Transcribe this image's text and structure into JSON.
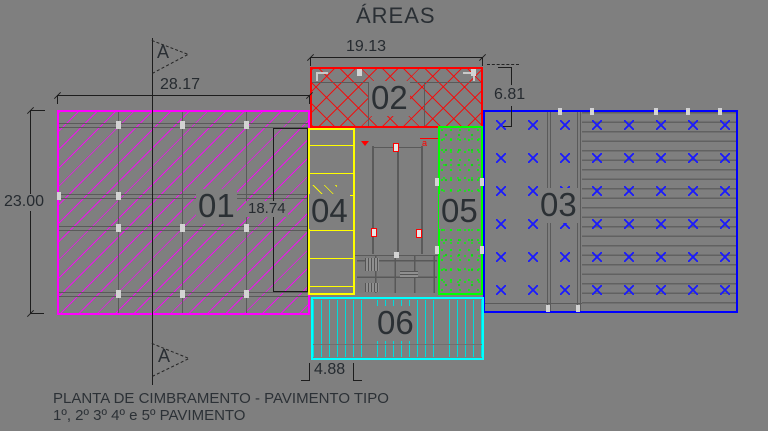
{
  "title": "ÁREAS",
  "section": {
    "label": "A"
  },
  "areas": {
    "a01": {
      "label": "01",
      "color": "#ff00ff"
    },
    "a02": {
      "label": "02",
      "color": "#ff0000"
    },
    "a03": {
      "label": "03",
      "color": "#0000ff",
      "x_grid": {
        "cols": 8,
        "rows": 6
      }
    },
    "a04": {
      "label": "04",
      "color": "#ffff00"
    },
    "a05": {
      "label": "05",
      "color": "#00ff00"
    },
    "a06": {
      "label": "06",
      "color": "#00ffff"
    }
  },
  "dimensions": {
    "area01_width": "28.17",
    "area01_height": "23.00",
    "area02_width": "19.13",
    "area02_height": "6.81",
    "core_height": "18.74",
    "area06_left_width": "4.88"
  },
  "core": {
    "door_letter": "a"
  },
  "notes": {
    "line1": "PLANTA DE CIMBRAMENTO - PAVIMENTO TIPO",
    "line2": "1º, 2º 3º 4º e 5º PAVIMENTO"
  },
  "background": "#7f7f7f"
}
